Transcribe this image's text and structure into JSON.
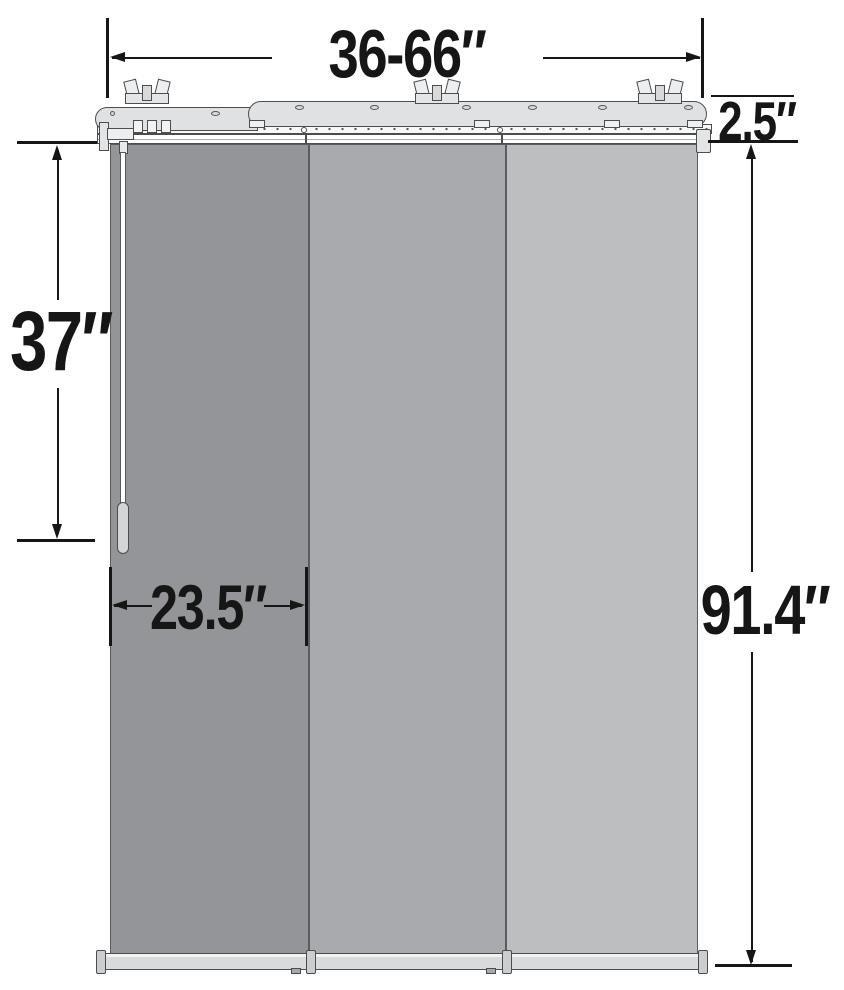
{
  "diagram": {
    "kind": "product-dimension-diagram",
    "subject": "three-panel sliding panel track blind with headrail, wand and bottom rails",
    "labels": {
      "width_range": "36-66″",
      "headrail_depth": "2.5″",
      "wand_length": "37″",
      "panel_width": "23.5″",
      "product_height": "91.4″"
    },
    "colors": {
      "outline": "#4D4D4F",
      "label_text": "#161616",
      "panel_1": "#949598",
      "panel_2": "#A8AAAD",
      "panel_3": "#BCBEC0",
      "headrail": "#E0E1E2",
      "bottom_rail": "#D9DADB",
      "rail_cap": "#CBCDCE",
      "wand_handle": "#D4D5D6",
      "background": "#FFFFFF"
    },
    "components": {
      "mounting_bracket_count": 3,
      "panel_count": 3,
      "bottom_rail_count": 3,
      "wand_count": 1
    }
  }
}
